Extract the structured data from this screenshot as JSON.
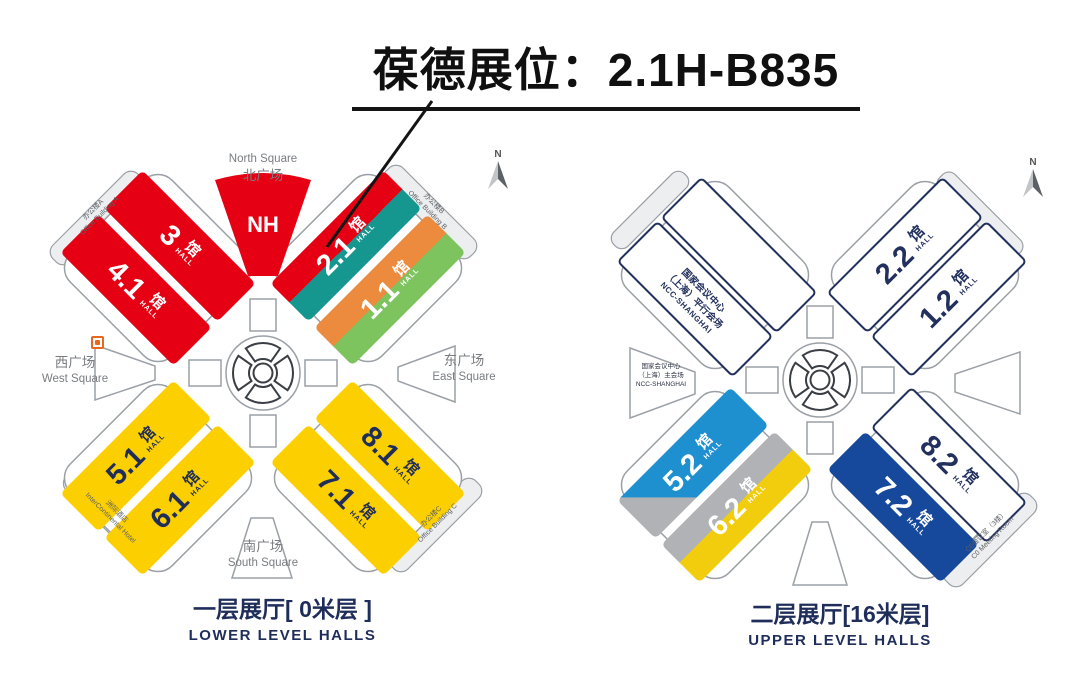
{
  "title": "葆德展位：2.1H-B835",
  "labels": {
    "guan": "馆",
    "hall": "HALL",
    "compass_n": "N"
  },
  "colors": {
    "red": "#e50113",
    "teal": "#15978f",
    "orange": "#ec8b3e",
    "green": "#7dc45f",
    "yellow": "#fccf00",
    "blue": "#1e8fcf",
    "dark_blue": "#16499b",
    "gray": "#b0b2b5",
    "navy_text": "#1f2d5a"
  },
  "lower_map": {
    "caption_zh": "一层展厅[ 0米层 ]",
    "caption_en": "LOWER LEVEL HALLS",
    "nh_label": "NH",
    "halls": {
      "h3": "3",
      "h41": "4.1",
      "h21": "2.1",
      "h11": "1.1",
      "h51": "5.1",
      "h61": "6.1",
      "h81": "8.1",
      "h71": "7.1"
    },
    "squares": {
      "north_en": "North Square",
      "north_zh": "北广场",
      "west_zh": "西广场",
      "west_en": "West Square",
      "east_zh": "东广场",
      "east_en": "East Square",
      "south_zh": "南广场",
      "south_en": "South Square"
    },
    "buildings": {
      "a_zh": "办公楼A",
      "a_en": "Office Building A",
      "b_zh": "办公楼B",
      "b_en": "Office Building B",
      "c_zh": "办公楼C",
      "c_en": "Office Building C",
      "hotel_zh": "洲际酒店",
      "hotel_en": "InterContinental Hotel"
    }
  },
  "upper_map": {
    "caption_zh": "二层展厅[16米层]",
    "caption_en": "UPPER LEVEL HALLS",
    "halls": {
      "h22": "2.2",
      "h12": "1.2",
      "h52": "5.2",
      "h62": "6.2",
      "h82": "8.2",
      "h72": "7.2"
    },
    "ncc_parallel": {
      "line1": "国家会议中心",
      "line2": "（上海）平行会场",
      "line3": "NCC-SHANGHAI"
    },
    "ncc_main": {
      "line1": "国家会议中心",
      "line2": "（上海）主会场",
      "line3": "NCC-SHANGHAI"
    },
    "c0_zh": "C0会议室（3楼）",
    "c0_en": "C0 Meeting Room"
  }
}
